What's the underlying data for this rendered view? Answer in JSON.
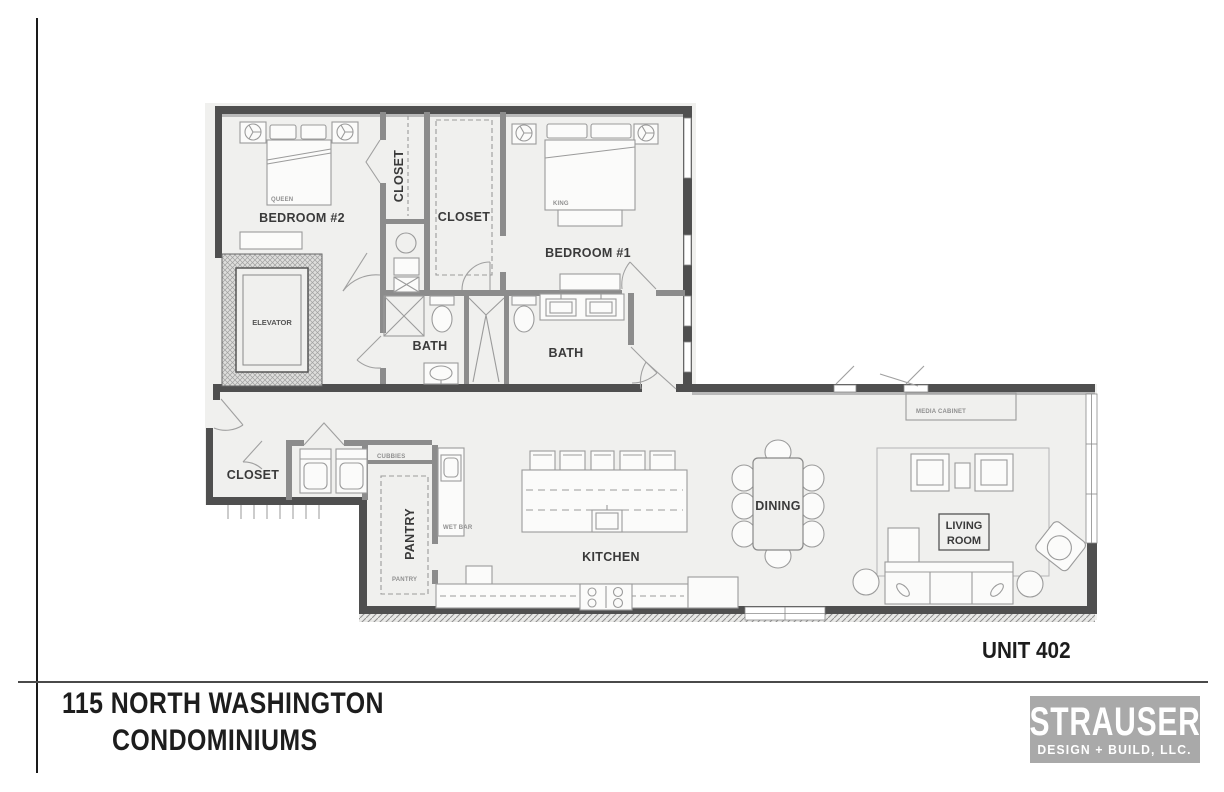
{
  "title": {
    "line1": "115 NORTH WASHINGTON",
    "line2": "CONDOMINIUMS"
  },
  "unit": {
    "label": "UNIT 402"
  },
  "logo": {
    "name": "STRAUSER",
    "tagline": "DESIGN + BUILD, LLC."
  },
  "rooms": {
    "bedroom2": "BEDROOM #2",
    "bedroom1": "BEDROOM #1",
    "closet_hall": "CLOSET",
    "closet_walkin": "CLOSET",
    "elevator": "ELEVATOR",
    "bath1": "BATH",
    "bath2": "BATH",
    "closet_entry": "CLOSET",
    "pantry": "PANTRY",
    "kitchen": "KITCHEN",
    "dining": "DINING",
    "living_line1": "LIVING",
    "living_line2": "ROOM"
  },
  "fixtures": {
    "queen": "QUEEN",
    "king": "KING",
    "cubbies": "CUBBIES",
    "wet_bar": "WET BAR",
    "pantry_small": "PANTRY",
    "desk": "DESK",
    "media_cabinet": "MEDIA CABINET"
  },
  "colors": {
    "plan_background": "#f0f0ee",
    "exterior_wall": "#4f4f4f",
    "interior_wall": "#8c8c8c",
    "logo_background": "#a9a9a9",
    "text_dark": "#1d1d1d"
  }
}
